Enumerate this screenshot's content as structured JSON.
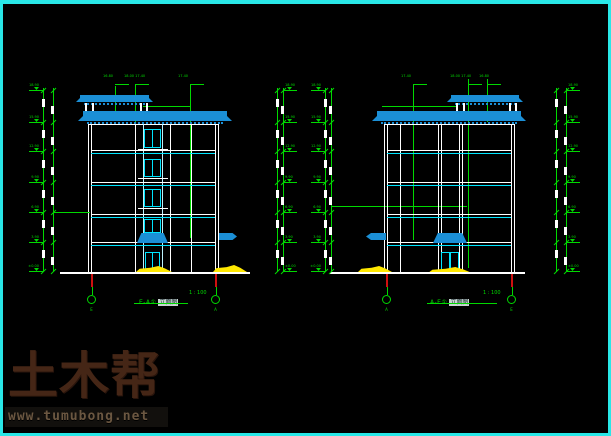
{
  "views": {
    "left_view": {
      "title_axis": "E-A①",
      "title_name": "立面图",
      "scale": "1 : 100",
      "bubble_left": "E",
      "bubble_right": "A",
      "roof_labels": [
        "16.80",
        "18.00 17.40",
        "17.40"
      ]
    },
    "right_view": {
      "title_axis": "A-E①",
      "title_name": "立面图",
      "scale": "1 : 100",
      "bubble_left": "A",
      "bubble_right": "E",
      "roof_labels": [
        "17.40",
        "18.00 17.40",
        "16.80"
      ]
    }
  },
  "dimensions": {
    "levels": [
      "18.90",
      "15.90",
      "12.90",
      "9.90",
      "6.90",
      "3.90",
      "±0.00"
    ],
    "floor_dim": "3000"
  },
  "watermark": {
    "logo": "土木帮",
    "url": "www.tumubong.net"
  },
  "colors": {
    "border": "#29e7e7",
    "green": "#00d900",
    "white": "#ffffff",
    "cyan": "#00e5ff",
    "pale_cyan": "#bdf3ff",
    "roof_blue": "#1b8fd6",
    "yellow": "#ffe800",
    "red": "#cf1010"
  }
}
